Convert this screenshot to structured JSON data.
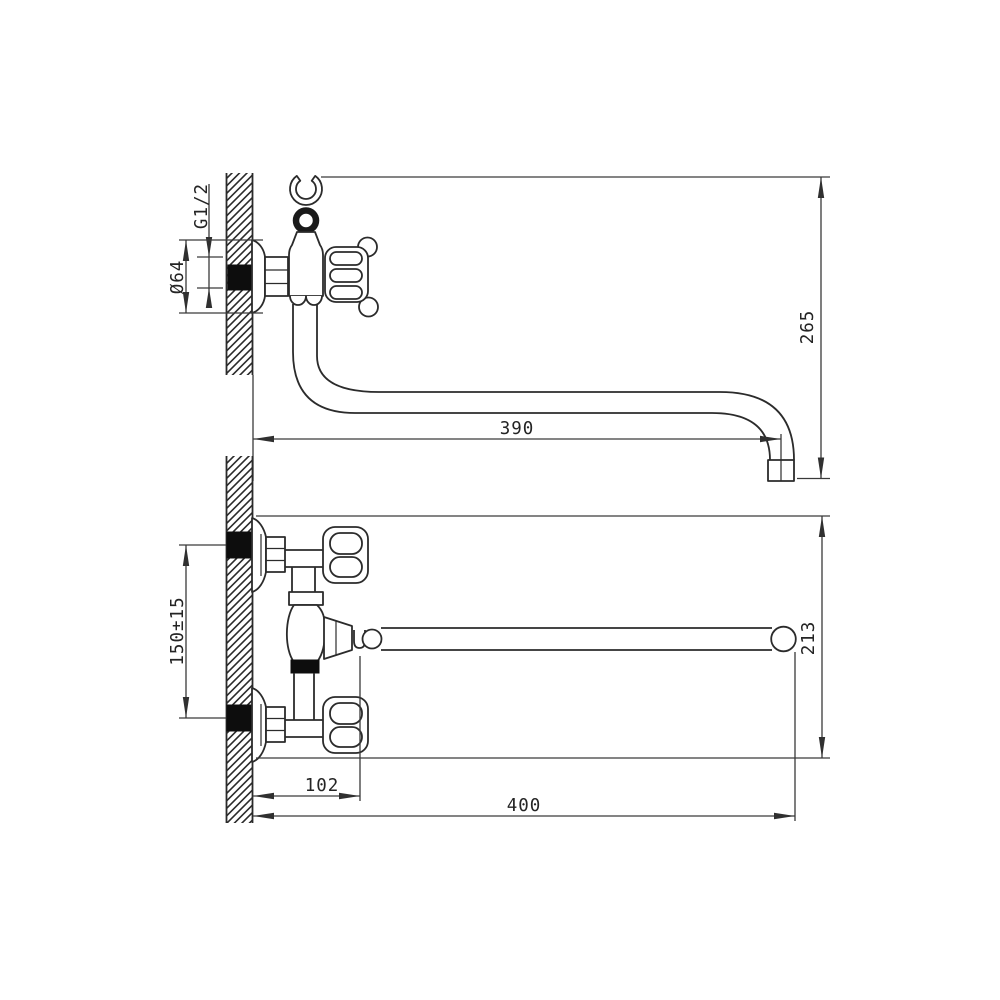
{
  "side_view": {
    "thread_size": "G1/2",
    "flange_diameter": "Ø64",
    "height_to_spout": "265",
    "spout_reach": "390"
  },
  "front_view": {
    "inlet_spacing": "150±15",
    "overall_height": "213",
    "wall_to_diverter": "102",
    "overall_reach": "400"
  },
  "colors": {
    "line": "#2b2b2b",
    "anchor_fill": "#0d0d0d",
    "background": "#ffffff"
  }
}
